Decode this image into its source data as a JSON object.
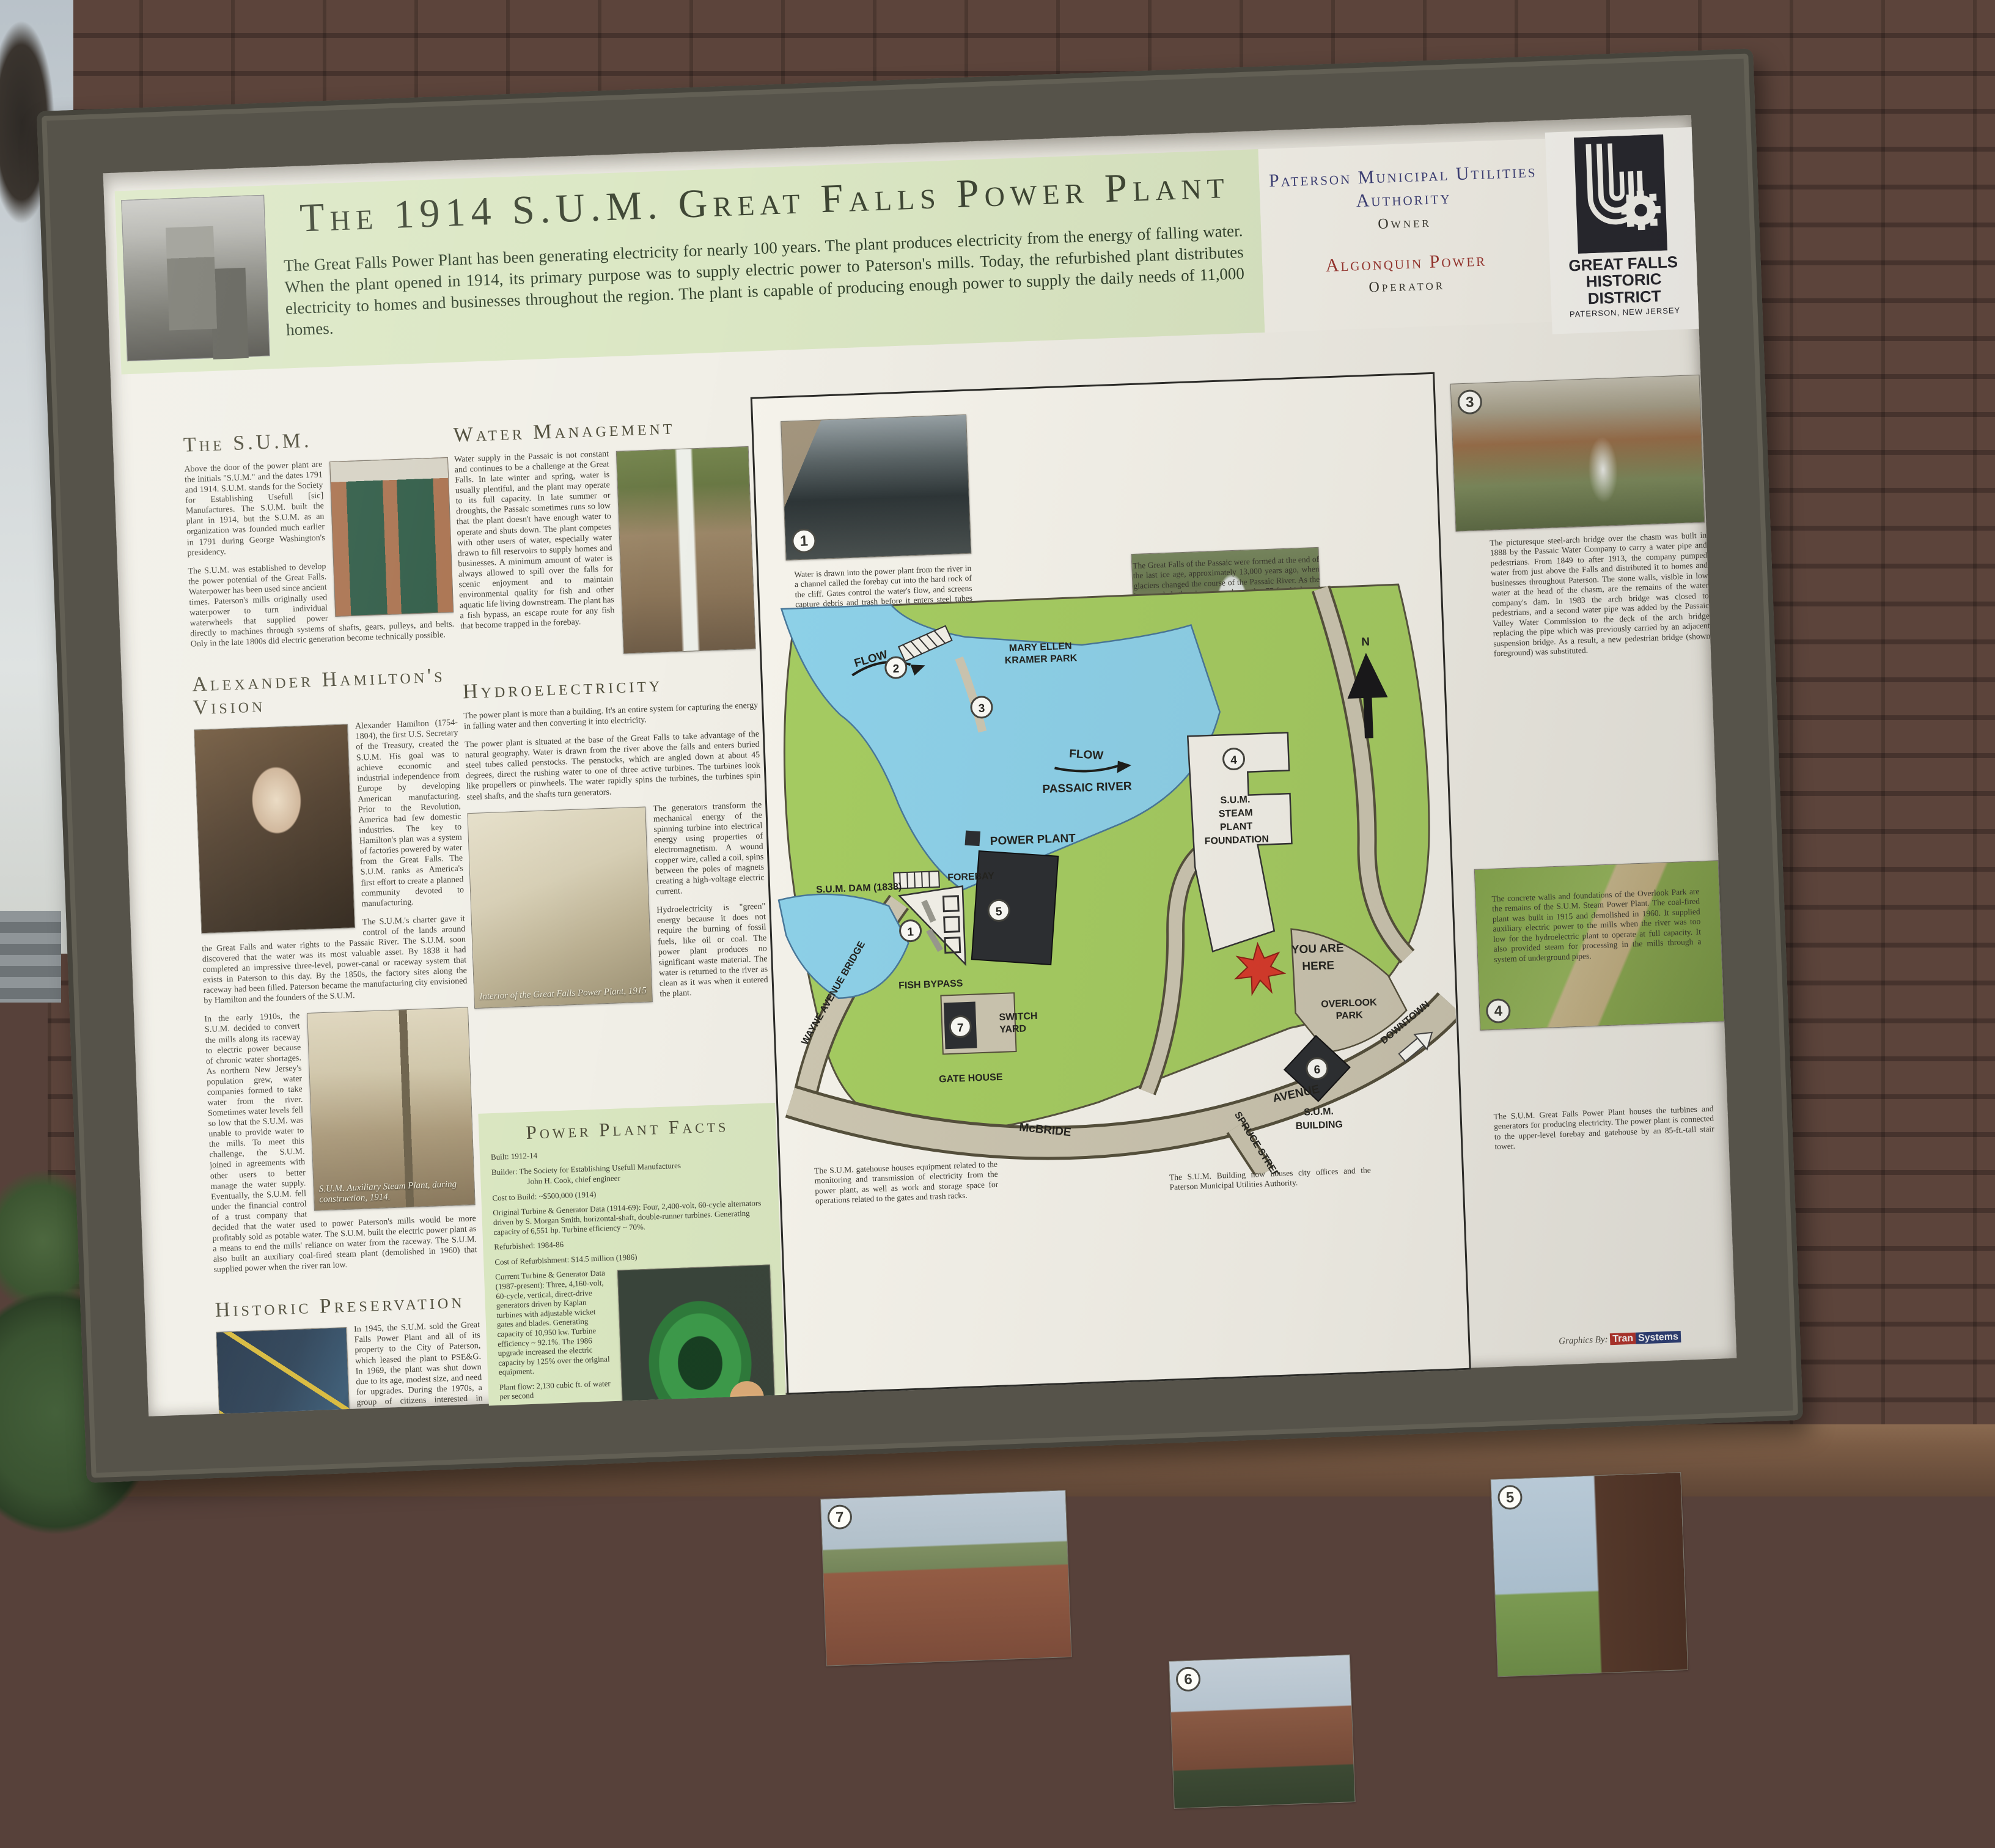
{
  "header": {
    "title": "The 1914 S.U.M. Great Falls Power Plant",
    "intro": "The Great Falls Power Plant has been generating electricity for nearly 100 years.  The plant produces electricity from the energy of falling water.  When the plant opened in 1914, its primary purpose was to supply electric power to Paterson's mills.  Today, the refurbished plant distributes electricity to homes and businesses throughout the region.  The plant is capable of producing enough power to supply the daily needs of 11,000 homes.",
    "owner_name": "Paterson Municipal Utilities Authority",
    "owner_role": "Owner",
    "operator_name": "Algonquin Power",
    "operator_role": "Operator",
    "logo_line1": "GREAT FALLS",
    "logo_line2": "HISTORIC DISTRICT",
    "logo_line3": "PATERSON, NEW JERSEY"
  },
  "sections": {
    "sum": {
      "heading": "The S.U.M.",
      "p1": "Above the door of the power plant are the initials \"S.U.M.\" and the dates 1791 and 1914.  S.U.M. stands for the Society for Establishing Usefull [sic] Manufactures.  The S.U.M. built the plant in 1914, but the S.U.M. as an organization was founded much earlier in 1791 during George Washington's presidency.",
      "p2": "The S.U.M. was established to develop the power potential of the Great Falls.  Waterpower has been used since ancient times.  Paterson's mills originally used waterpower to turn individual waterwheels that supplied power directly to machines through systems of shafts, gears, pulleys, and belts.  Only in the late 1800s did electric generation become technically possible."
    },
    "hamilton": {
      "heading": "Alexander Hamilton's Vision",
      "p1": "Alexander Hamilton (1754-1804), the first U.S. Secretary of the Treasury, created the S.U.M. His goal was to achieve economic and industrial independence from Europe by developing American manufacturing.  Prior to the Revolution, America had few domestic industries.  The key to Hamilton's plan was a system of factories powered by water from the Great Falls.  The S.U.M. ranks as America's first effort to create a planned community devoted to manufacturing.",
      "p2": "The S.U.M.'s charter gave it control of the lands around the Great Falls and water rights to the Passaic River.  The S.U.M. soon discovered that the water was its most valuable asset.  By 1838 it had completed an impressive three-level, power-canal or raceway system that exists in Paterson to this day.  By the 1850s, the factory sites along the raceway had been filled.  Paterson became the manufacturing city envisioned by Hamilton and the founders of the S.U.M.",
      "p3": "In the early 1910s, the S.U.M. decided to convert the mills along its raceway to electric power because of chronic water shortages.  As northern New Jersey's population grew, water companies formed to take water from the river.  Sometimes water levels fell so low that the S.U.M. was unable to provide water to the mills.  To meet this challenge, the S.U.M. joined in agreements with other users to better manage the water supply.  Eventually, the S.U.M. fell under the financial control of a trust company that decided that the water used to power Paterson's mills would be more profitably sold as potable water.  The S.U.M. built the electric power plant as a means to end the mills' reliance on water from the raceway.  The S.U.M. also built an auxiliary coal-fired steam plant (demolished in 1960) that supplied power when the river ran low.",
      "photo_caption": "S.U.M. Auxiliary Steam Plant, during construction, 1914."
    },
    "preservation": {
      "heading": "Historic Preservation",
      "p1": "In 1945, the S.U.M. sold the Great Falls Power Plant and all of its property to the City of Paterson, which leased the plant to PSE&G. In 1969, the plant was shut down due to its age, modest size, and need for upgrades.  During the 1970s, a group of citizens interested in preservation looked into the possibility of returning the plant to operation.  Through a combination of federal grants and private investment, they came up with a plan.  In 1980, the City of Paterson established the Paterson Municipal Utilities Authority (MUA) to own and operate the plant.  The MUA eventually partnered with the Great Falls Hydroelectric Company to raise $14.5 million from private investments; no local tax dollars were used.  The old turbines and generators from 1914 were replaced with more efficient, modern units.  One of the original units was left in place as a historic display.  The modern equipment was installed with little impact on the historic appearance of the plant.  The plant resumed operations in 1986.  Algonquin Power of Toronto, a specialist in the operation of smaller hydroelectric plants, took over operations in 2000."
    },
    "water": {
      "heading": "Water Management",
      "p1": "Water supply in the Passaic is not constant and continues to be a challenge at the Great Falls.  In late winter and spring, water is usually plentiful, and the plant may operate to its full capacity.  In late summer or droughts, the Passaic sometimes runs so low that the plant doesn't have enough water to operate and shuts down.  The plant competes with other users of water, especially water drawn to fill reservoirs to supply homes and businesses.  A minimum amount of water is always allowed to spill over the falls for scenic enjoyment and to maintain environmental quality for fish and other aquatic life living downstream.  The plant has a fish bypass, an escape route for any fish that become trapped in the forebay."
    },
    "hydro": {
      "heading": "Hydroelectricity",
      "p1": "The power plant is more than a building.  It's an entire system for capturing the energy in falling water and then converting it into electricity.",
      "p2": "The power plant is situated at the base of the Great Falls to take advantage of the natural geography.  Water is drawn from the river above the falls and enters buried steel tubes called penstocks.  The penstocks, which are angled down at about 45 degrees, direct the rushing water to one of three active turbines.  The turbines look like propellers or pinwheels.  The water rapidly spins the turbines, the turbines spin steel shafts, and the shafts turn generators.",
      "p3": "The generators transform the mechanical energy of the spinning turbine into electrical energy using properties of electromagnetism.  A wound copper wire, called a coil, spins between the poles of magnets creating a high-voltage electric current.",
      "p4": "Hydroelectricity is \"green\" energy because it does not require the burning of fossil fuels, like oil or coal.  The power plant produces no significant waste material.  The water is returned to the river as clean as it was when it entered the plant.",
      "photo_caption": "Interior of the Great Falls Power Plant, 1915"
    },
    "facts": {
      "heading": "Power Plant Facts",
      "items": [
        "Built: 1912-14",
        "Builder:  The Society for Establishing Usefull Manufactures",
        "John H. Cook, chief engineer",
        "Cost to Build: ~$500,000 (1914)",
        "Original Turbine & Generator Data (1914-69): Four, 2,400-volt, 60-cycle alternators driven by S. Morgan Smith, horizontal-shaft, double-runner turbines.  Generating capacity of 6,551 hp. Turbine efficiency ~ 70%.",
        "Refurbished: 1984-86",
        "Cost of Refurbishment: $14.5 million (1986)",
        "Current Turbine & Generator Data (1987-present): Three, 4,160-volt, 60-cycle, vertical, direct-drive generators driven by Kaplan turbines with adjustable wicket gates and blades.  Generating capacity of 10,950 kw.  Turbine efficiency ~ 92.1%.  The 1986 upgrade increased the electric capacity by 125% over the original equipment.",
        "Plant flow: 2,130 cubic ft. of water per second",
        "Net Head-Rated: 67.9 ft.",
        "The Great Falls Raceway and Power System is a National Historic Civil and Mechanical Engineering Landmark.",
        "In 2009, Congress established the Great Falls National Historical Park.",
        "For tour information, call the Great Falls Historic District Cultural Center at (973) 279-9587."
      ]
    }
  },
  "map": {
    "labels": {
      "park1": "MARY ELLEN",
      "park2": "KRAMER PARK",
      "flow": "FLOW",
      "river": "PASSAIC RIVER",
      "dam": "S.U.M. DAM (1838)",
      "forebay": "FOREBAY",
      "power_plant": "POWER PLANT",
      "fish_bypass": "FISH BYPASS",
      "wayne_bridge": "WAYNE AVENUE BRIDGE",
      "sy1": "SWITCH",
      "sy2": "YARD",
      "gate_house": "GATE HOUSE",
      "mcbride": "McBRIDE",
      "avenue": "AVENUE",
      "spruce": "SPRUCE STREET",
      "downtown": "DOWNTOWN",
      "op1": "OVERLOOK",
      "op2": "PARK",
      "spf1": "S.U.M.",
      "spf2": "STEAM",
      "spf3": "PLANT",
      "spf4": "FOUNDATION",
      "yah1": "YOU ARE",
      "yah2": "HERE",
      "sb1": "S.U.M.",
      "sb2": "BUILDING",
      "compass": "N"
    },
    "markers": {
      "m1": "1",
      "m2": "2",
      "m3": "3",
      "m4": "4",
      "m5": "5",
      "m6": "6",
      "m7": "7"
    },
    "captions": {
      "c1": "Water is drawn into the power plant from the river in a channel called the forebay cut into the hard rock of the cliff.  Gates control the water's flow, and screens capture debris and trash before it enters steel tubes called penstocks.",
      "c2": "The Great Falls of the Passaic were formed at the end of the last ice age, approximately 13,000 years ago, when glaciers changed the course of the Passaic River.  As the ice receded, the river carved out the 77-ft.- high and 280-ft.- wide falls.  The rock underlying the falls is an erosion-resistant ridge of ancient basalt, also known as trap rock.",
      "c3": "The picturesque steel-arch bridge over the chasm was built in 1888 by the Passaic Water Company to carry a water pipe and pedestrians.  From 1849 to after 1913, the company pumped water from just above the Falls and distributed it to homes and businesses throughout Paterson.  The stone walls, visible in low water at the head of the chasm, are the remains of the water company's dam.  In 1983 the arch bridge was closed to pedestrians, and a second water pipe was added by the Passaic Valley Water Commission to the deck of the arch bridge replacing the pipe which was previously carried by an adjacent suspension bridge.  As a result, a new pedestrian bridge (shown foreground) was substituted.",
      "c4": "The concrete walls and foundations of the Overlook Park are the remains of the S.U.M. Steam Power Plant.  The coal-fired plant was built in 1915 and demolished in 1960.  It supplied auxiliary electric power to the mills when the river was too low for the hydroelectric plant to operate at full capacity.  It also provided steam for processing in the mills through a system of underground pipes.",
      "c5": "The S.U.M. Great Falls Power Plant houses the turbines and generators for producing electricity.  The power plant is connected to the upper-level forebay and gatehouse by an 85-ft.-tall stair tower.",
      "c6": "The S.U.M. Building now houses city offices and the Paterson Municipal Utilities Authority.",
      "c7": "The S.U.M. gatehouse houses equipment related to the monitoring and transmission of electricity from the power plant, as well as work and storage space for operations related to the gates and trash racks."
    }
  },
  "credits": {
    "label": "Graphics By:",
    "firm1": "Tran",
    "firm2": "Systems"
  }
}
